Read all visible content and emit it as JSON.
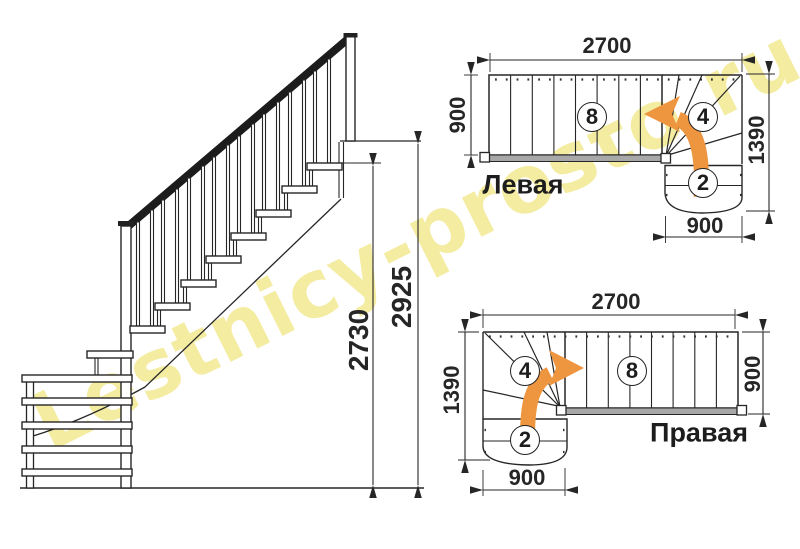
{
  "watermark": {
    "text": "Lestnicy-prosto.ru"
  },
  "colors": {
    "arrow": "#EE9540",
    "watermark": "rgba(238,227,118,0.85)",
    "stringer": "#A8A8A8",
    "line": "#262626"
  },
  "elevation": {
    "dims": {
      "inner": "2730",
      "outer": "2925"
    }
  },
  "plan_left": {
    "label": "Левая",
    "dims": {
      "top": "2700",
      "left": "900",
      "right": "1390",
      "bottom": "900"
    },
    "steps": {
      "straight": "8",
      "winder": "4",
      "lower": "2"
    }
  },
  "plan_right": {
    "label": "Правая",
    "dims": {
      "top": "2700",
      "left": "1390",
      "right": "900",
      "bottom": "900"
    },
    "steps": {
      "straight": "8",
      "winder": "4",
      "lower": "2"
    }
  }
}
